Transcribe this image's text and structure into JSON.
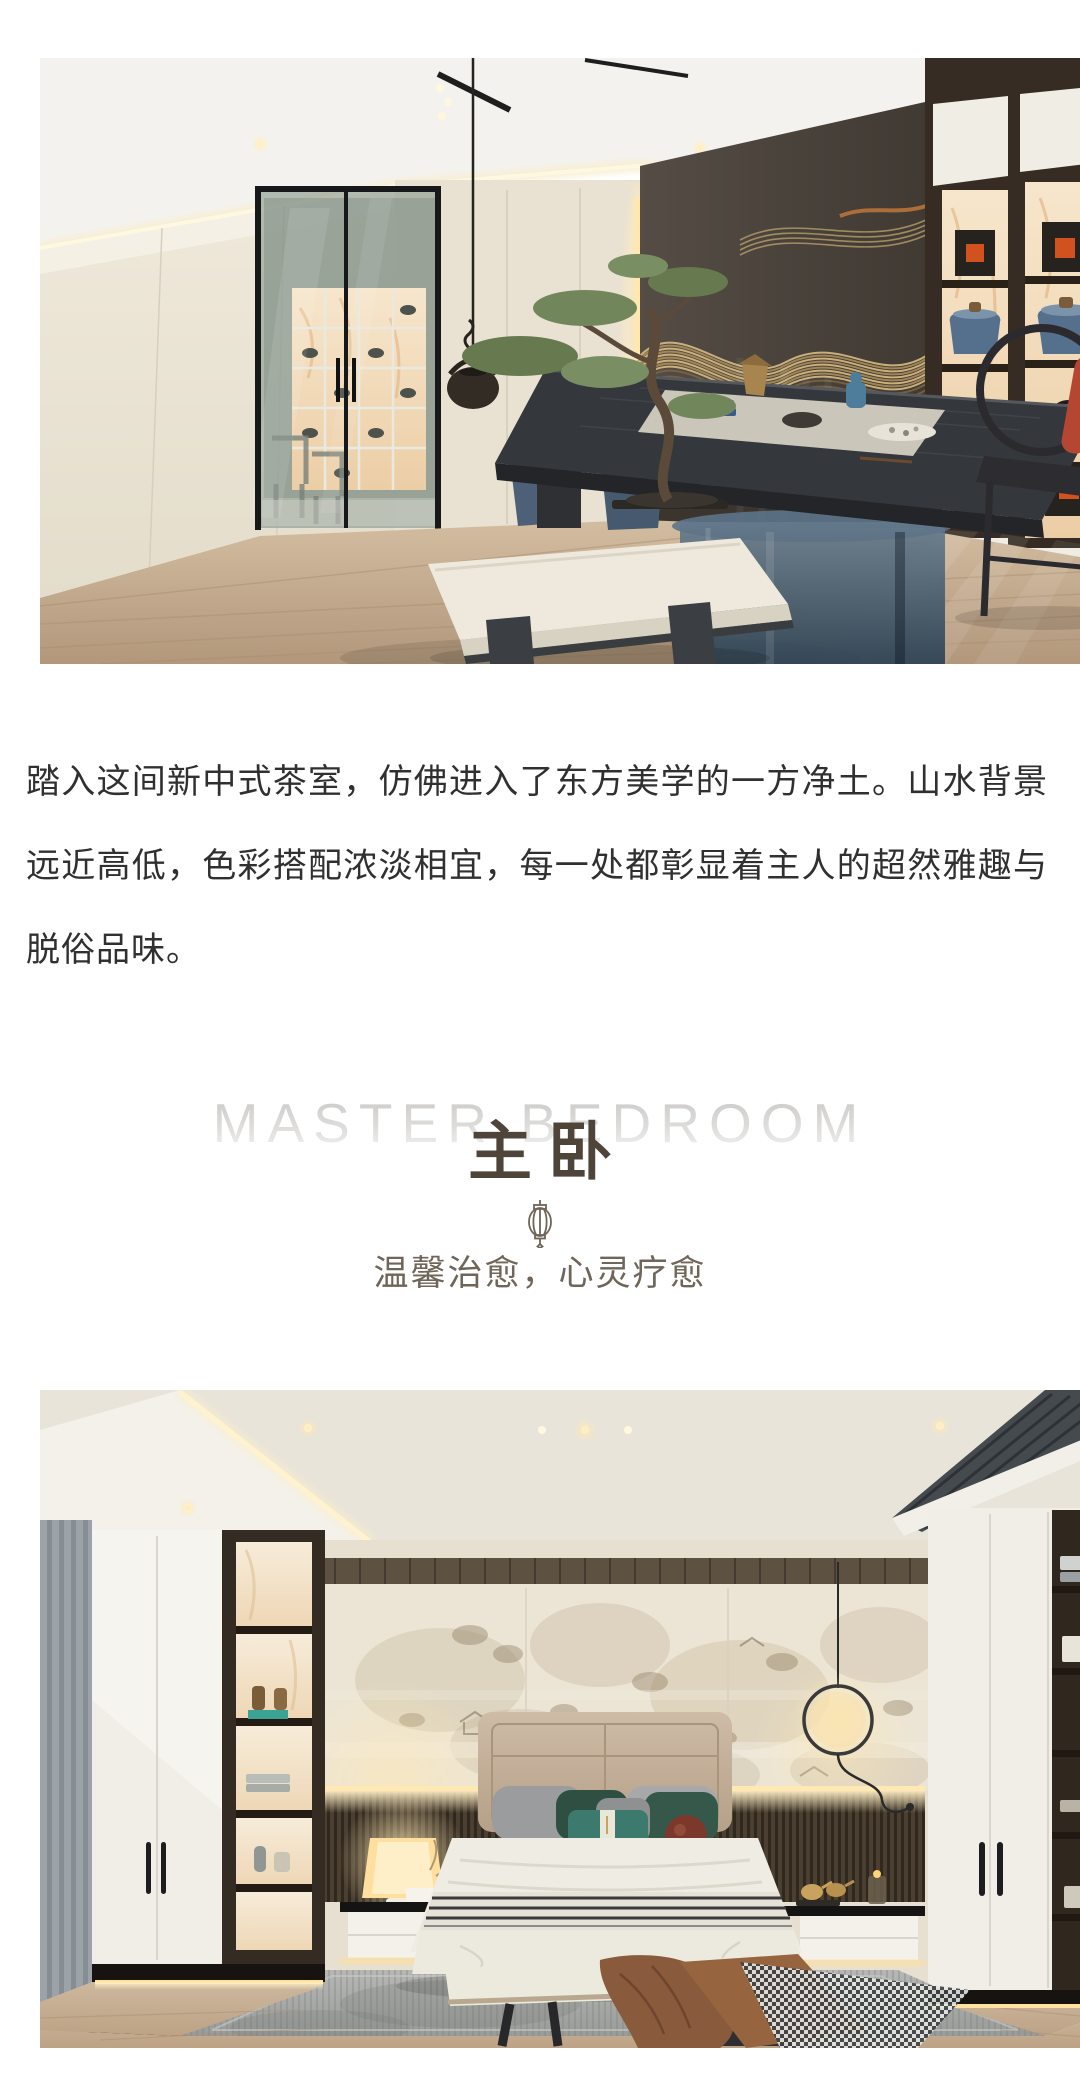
{
  "intro": {
    "paragraph": "踏入这间新中式茶室，仿佛进入了东方美学的一方净土。山水背景远近高低，色彩搭配浓淡相宜，每一处都彰显着主人的超然雅趣与脱俗品味。"
  },
  "section_header": {
    "title_en": "MASTER BEDROOM",
    "title_zh": "主卧",
    "subtitle": "温馨治愈，心灵疗愈",
    "icon": "lantern-icon"
  },
  "photos": {
    "tea_room": "tea-room-render",
    "bedroom": "master-bedroom-render"
  },
  "colors": {
    "page_bg": "#ffffff",
    "body_text": "#303030",
    "title_en": "#d9d8d6",
    "title_zh": "#4e443a",
    "subtitle_text": "#6f6558",
    "lantern_stroke": "#6f6558",
    "accent_gold": "#c7a66b",
    "accent_teal": "#2e8c7f",
    "accent_red": "#b54732"
  }
}
